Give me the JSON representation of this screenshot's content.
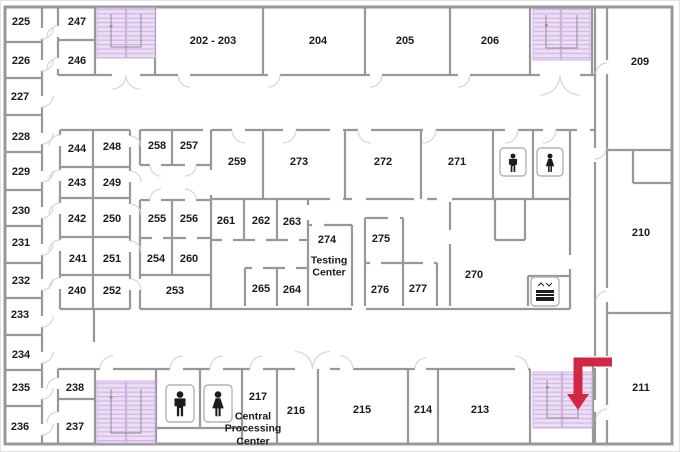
{
  "colors": {
    "bg": "#ffffff",
    "frame": "#e3e3e3",
    "wall": "#989898",
    "door-arc": "#d8d8d8",
    "stair-fill": "#ecdef4",
    "stair-line": "#cfb2e2",
    "stair-guide": "#8f8f8f",
    "icon": "#1c1c1c",
    "icon-border": "#b3b3b3",
    "arrow": "#d22742",
    "label": "#1b1b1b"
  },
  "rooms": {
    "r225": "225",
    "r226": "226",
    "r227": "227",
    "r228": "228",
    "r229": "229",
    "r230": "230",
    "r231": "231",
    "r232": "232",
    "r233": "233",
    "r234": "234",
    "r235": "235",
    "r236": "236",
    "r247": "247",
    "r246": "246",
    "r202_203": "202 - 203",
    "r204": "204",
    "r205": "205",
    "r206": "206",
    "r209": "209",
    "r210": "210",
    "r211": "211",
    "r244": "244",
    "r248": "248",
    "r243": "243",
    "r249": "249",
    "r242": "242",
    "r250": "250",
    "r241": "241",
    "r251": "251",
    "r240": "240",
    "r252": "252",
    "r258": "258",
    "r257": "257",
    "r255": "255",
    "r256": "256",
    "r254": "254",
    "r260": "260",
    "r253": "253",
    "r259": "259",
    "r273": "273",
    "r272": "272",
    "r271": "271",
    "r261": "261",
    "r262": "262",
    "r263": "263",
    "r265": "265",
    "r264": "264",
    "r274": "274",
    "r275": "275",
    "r276": "276",
    "r277": "277",
    "r270": "270",
    "r238": "238",
    "r237": "237",
    "r217": "217",
    "r216": "216",
    "r215": "215",
    "r214": "214",
    "r213": "213"
  },
  "annotations": {
    "testing_center": "Testing Center",
    "central_processing_center": "Central Processing Center"
  },
  "icons": {
    "stairwells": [
      "stairwell-top-left",
      "stairwell-top-right",
      "stairwell-bottom-left",
      "stairwell-bottom-right"
    ],
    "restrooms": [
      "mens-restroom-upper",
      "womens-restroom-upper",
      "mens-restroom-lower",
      "womens-restroom-lower"
    ],
    "elevator": "elevator-icon",
    "red_arrow_points_to": "stairwell-bottom-right"
  }
}
